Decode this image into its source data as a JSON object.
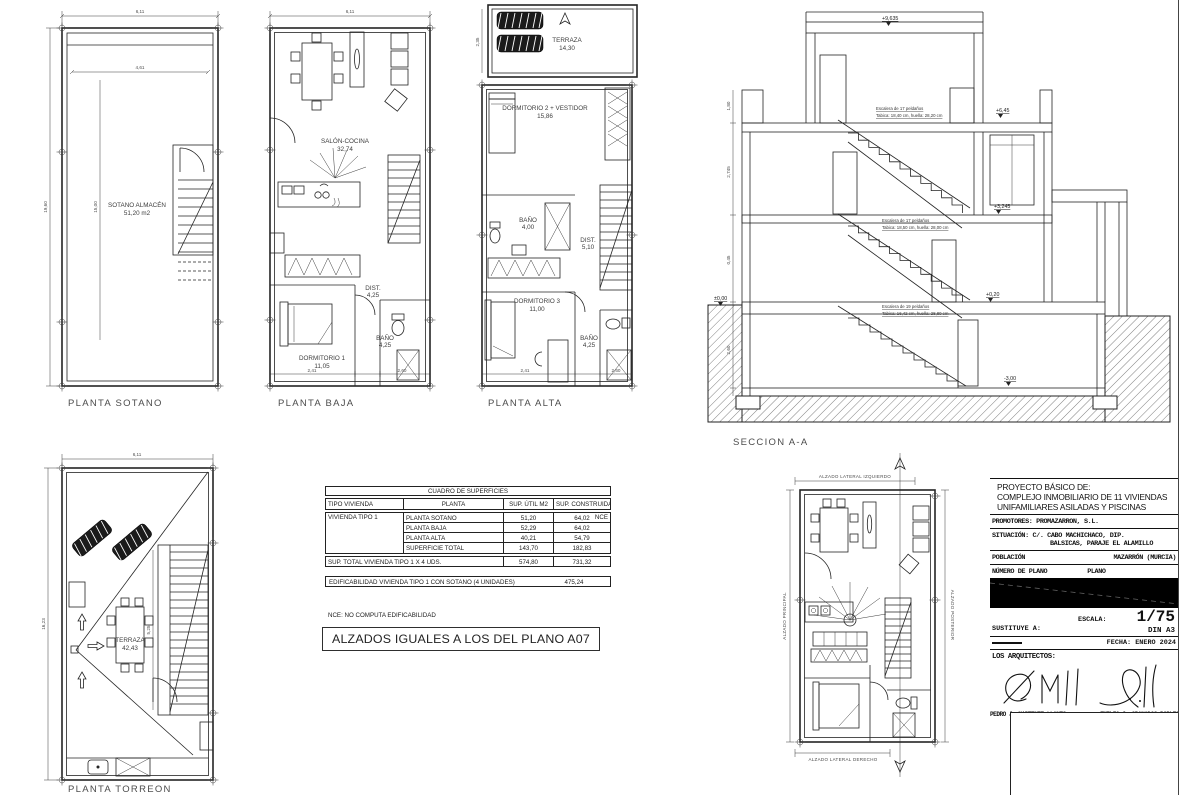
{
  "sheet": {
    "background": "#ffffff",
    "line_color": "#242424"
  },
  "plans": {
    "sotano": {
      "title": "PLANTA SOTANO",
      "room_name": "SOTANO ALMACÉN",
      "room_area": "51,20 m2",
      "dim_width": "6,11",
      "dim_height": "19,60",
      "dim_inner_width": "4,61",
      "dim_inner_height": "15,00"
    },
    "baja": {
      "title": "PLANTA BAJA",
      "dim_width": "6,11",
      "salon_name": "SALÓN-COCINA",
      "salon_area": "32,74",
      "dist_name": "DIST.",
      "dist_area": "4,25",
      "dorm_name": "DORMITORIO 1",
      "dorm_area": "11,05",
      "bano_name": "BAÑO",
      "bano_area": "4,25",
      "dim_b1": "2,41",
      "dim_b2": "2,60"
    },
    "alta": {
      "title": "PLANTA ALTA",
      "terraza_name": "TERRAZA",
      "terraza_area": "14,30",
      "dorm2_name": "DORMITORIO 2 + VESTIDOR",
      "dorm2_area": "15,86",
      "bano1_name": "BAÑO",
      "bano1_area": "4,00",
      "dist_name": "DIST.",
      "dist_area": "5,10",
      "dorm3_name": "DORMITORIO 3",
      "dorm3_area": "11,00",
      "bano2_name": "BAÑO",
      "bano2_area": "4,25",
      "dim_terraza": "2,35",
      "dim_b1": "2,41",
      "dim_b2": "2,60"
    },
    "seccion": {
      "title": "SECCION A-A",
      "level_top": "+9,635",
      "level_p1": "+6,45",
      "level_p2": "+3,245",
      "level_ground_right": "+0,20",
      "level_zero": "±0,00",
      "level_basement": "-3,00",
      "stair1_line1": "Escalera de 17 peldaños",
      "stair1_line2": "Tabica: 18,40 cm, huella: 28,20 cm",
      "stair2_line1": "Escalera de 17 peldaños",
      "stair2_line2": "Tabica: 18,50 cm, huella: 28,00 cm",
      "stair3_line1": "Escalera de 19 peldaños",
      "stair3_line2": "Tabica: 16,42 cm, huella: 28,80 cm",
      "dim1": "1,80",
      "dim2": "2,745",
      "dim3": "2,60",
      "dim4": "0,45"
    },
    "torreon": {
      "title": "PLANTA TORREON",
      "terraza_name": "TERRAZA",
      "terraza_area": "42,43",
      "dim_width": "6,11",
      "dim_height": "16,23",
      "dim_stair": "5,25"
    },
    "torreon_planta": {
      "label_top": "ALZADO LATERAL IZQUIERDO",
      "label_left": "ALZADO PRINCIPAL",
      "label_right": "ALZADO POSTERIOR",
      "label_bottom": "ALZADO LATERAL DERECHO"
    }
  },
  "surfaces_table": {
    "title": "CUADRO DE SUPERFICIES",
    "col_tipo": "TIPO VIVIENDA",
    "col_planta": "PLANTA",
    "col_util": "SUP. ÚTIL M2",
    "col_construida": "SUP. CONSTRUIDA M2",
    "tipo": "VIVIENDA TIPO 1",
    "rows": [
      {
        "planta": "PLANTA SOTANO",
        "util": "51,20",
        "construida": "64,02",
        "nce": "NCE"
      },
      {
        "planta": "PLANTA BAJA",
        "util": "52,29",
        "construida": "64,02",
        "nce": ""
      },
      {
        "planta": "PLANTA ALTA",
        "util": "40,21",
        "construida": "54,79",
        "nce": ""
      },
      {
        "planta": "SUPERFICIE TOTAL",
        "util": "143,70",
        "construida": "182,83",
        "nce": ""
      }
    ],
    "total_label": "SUP. TOTAL VIVIENDA TIPO 1 X 4 UDS.",
    "total_util": "574,80",
    "total_construida": "731,32",
    "edificabilidad_label": "EDIFICABILIDAD VIVIENDA TIPO 1 CON SOTANO (4 UNIDADES)",
    "edificabilidad_value": "475,24",
    "nce_note": "NCE:  NO COMPUTA EDIFICABILIDAD"
  },
  "note_box": {
    "text": "ALZADOS IGUALES A LOS DEL PLANO A07"
  },
  "title_block": {
    "project_label": "PROYECTO BÁSICO DE:",
    "project_line1": "COMPLEJO INMOBILIARIO DE 11 VIVIENDAS",
    "project_line2": "UNIFAMILIARES ASILADAS Y PISCINAS",
    "promotores": "PROMOTORES: PROMAZARRON, S.L.",
    "situacion_line1": "SITUACIÓN: C/. CABO MACHICHACO, DIP.",
    "situacion_line2": "BALSICAS, PARAJE EL ALAMILLO",
    "poblacion_label": "POBLACIÓN",
    "poblacion_value": "MAZARRÓN (MURCIA)",
    "numero_plano_label": "NÚMERO DE PLANO",
    "plano_label": "PLANO",
    "sustituye_label": "SUSTITUYE A:",
    "escala_label": "ESCALA:",
    "escala_value": "1/75",
    "formato": "DIN A3",
    "fecha": "FECHA: ENERO 2024",
    "arquitectos_label": "LOS ARQUITECTOS:",
    "arquitecto1": "PEDRO J. MARTINEZ LLANES",
    "telefono1": "607 962 308",
    "arquitecto2": "EMILIO J. GRANADOS ROBLES",
    "telefono2": "655 200 83"
  }
}
